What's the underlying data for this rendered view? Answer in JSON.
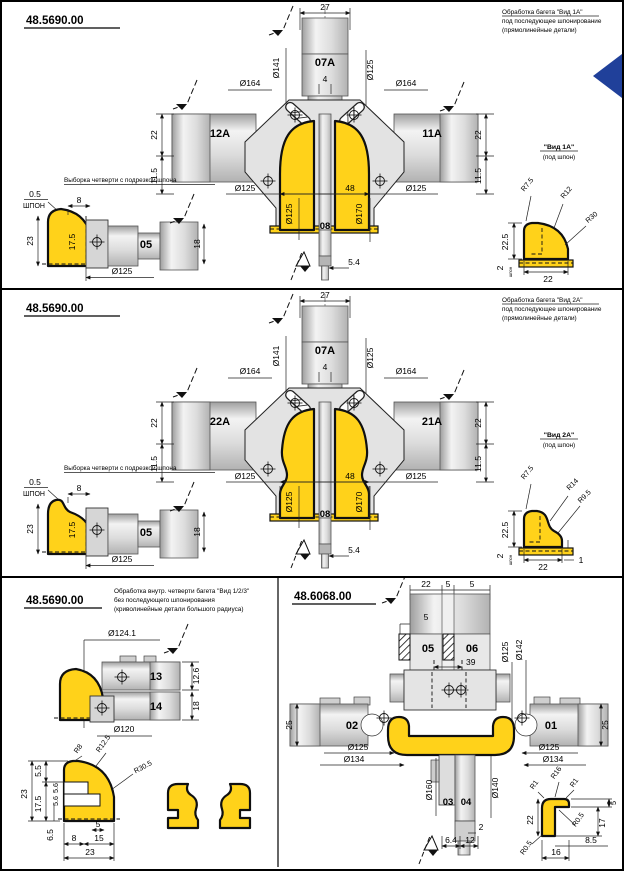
{
  "page": {
    "accent_blue": "#20409a",
    "metal_gray": "#d9d9d9",
    "profile_yellow": "#ffd21a"
  },
  "panel1": {
    "title": "48.5690.00",
    "note": [
      "Обработка багета \"Вид 1А\"",
      "под последующее шпонирование",
      "(прямолинейные детали)"
    ],
    "main": {
      "w27": "27",
      "spindle": "07А",
      "w4": "4",
      "d141": "Ø141",
      "d125": "Ø125",
      "d164l": "Ø164",
      "d164r": "Ø164",
      "blockL": "12А",
      "blockR": "11А",
      "h22l": "22",
      "h115l": "11.5",
      "h22r": "22",
      "h115r": "11.5",
      "d125bl": "Ø125",
      "w48": "48",
      "d125br": "Ø125",
      "d125v": "Ø125",
      "d170v": "Ø170",
      "shaft": "08",
      "w54": "5.4"
    },
    "rebate": {
      "title": "Выборка четверти с подрезкой шпона",
      "t05": "0.5",
      "veneer": "ШПОН",
      "w8": "8",
      "h23": "23",
      "h175": "17.5",
      "block": "05",
      "h18": "18",
      "d125": "Ø125"
    },
    "view": {
      "title": "\"Вид 1А\"",
      "sub": "(под шпон)",
      "r1": "R7.5",
      "r2": "R12",
      "r3": "R30",
      "h225": "22.5",
      "w22": "22",
      "t2": "2",
      "tiny": "шпон"
    }
  },
  "panel2": {
    "title": "48.5690.00",
    "note": [
      "Обработка багета \"Вид 2А\"",
      "под последующее шпонирование",
      "(прямолинейные детали)"
    ],
    "main": {
      "w27": "27",
      "spindle": "07А",
      "w4": "4",
      "d141": "Ø141",
      "d125": "Ø125",
      "d164l": "Ø164",
      "d164r": "Ø164",
      "blockL": "22А",
      "blockR": "21А",
      "h22l": "22",
      "h115l": "11.5",
      "h22r": "22",
      "h115r": "11.5",
      "d125bl": "Ø125",
      "w48": "48",
      "d125br": "Ø125",
      "d125v": "Ø125",
      "d170v": "Ø170",
      "shaft": "08",
      "w54": "5.4"
    },
    "rebate": {
      "title": "Выборка четверти с подрезкой шпона",
      "t05": "0.5",
      "veneer": "ШПОН",
      "w8": "8",
      "h23": "23",
      "h175": "17.5",
      "block": "05",
      "h18": "18",
      "d125": "Ø125"
    },
    "view": {
      "title": "\"Вид 2А\"",
      "sub": "(под шпон)",
      "r1": "R7.5",
      "r2": "R14",
      "r3": "R9.5",
      "h225": "22.5",
      "w22": "22",
      "t2": "2",
      "t1": "1",
      "tiny": "шпон"
    }
  },
  "panel3": {
    "left": {
      "title": "48.5690.00",
      "note": [
        "Обработка внутр. четверти багета \"Вид 1/2/3\"",
        "без последующего шпонирования",
        "(криволинейные детали большого радиуса)"
      ],
      "d1241": "Ø124.1",
      "b13": "13",
      "b14": "14",
      "h126": "12.6",
      "h18": "18",
      "d120": "Ø120",
      "prof": {
        "h55": "5.5",
        "r8": "R8",
        "r125": "R12.5",
        "r305": "R30.5",
        "h23": "23",
        "h175": "17.5",
        "h56a": "5.6",
        "h56b": "5.6",
        "h65": "6.5",
        "w5": "5",
        "w8": "8",
        "w15": "15",
        "w23": "23"
      }
    },
    "right": {
      "title": "48.6068.00",
      "w22a": "22",
      "w5top": "5",
      "w22b": "22",
      "h5": "5",
      "b05": "05",
      "b06": "06",
      "w39": "39",
      "d125v": "Ø125",
      "d142v": "Ø142",
      "b02": "02",
      "b01": "01",
      "h25l": "25",
      "h25r": "25",
      "d125l": "Ø125",
      "d134l": "Ø134",
      "d125r": "Ø125",
      "d134r": "Ø134",
      "d160v": "Ø160",
      "d140v": "Ø140",
      "b03": "03",
      "b04": "04",
      "t2": "2",
      "w64": "6.4",
      "w12": "12",
      "prof": {
        "r16": "R16",
        "r1l": "R1",
        "r1r": "R1",
        "h5": "5",
        "r05a": "R0.5",
        "h17": "17",
        "w85": "8.5",
        "r05b": "R0.5",
        "w16": "16",
        "h22": "22"
      }
    }
  }
}
